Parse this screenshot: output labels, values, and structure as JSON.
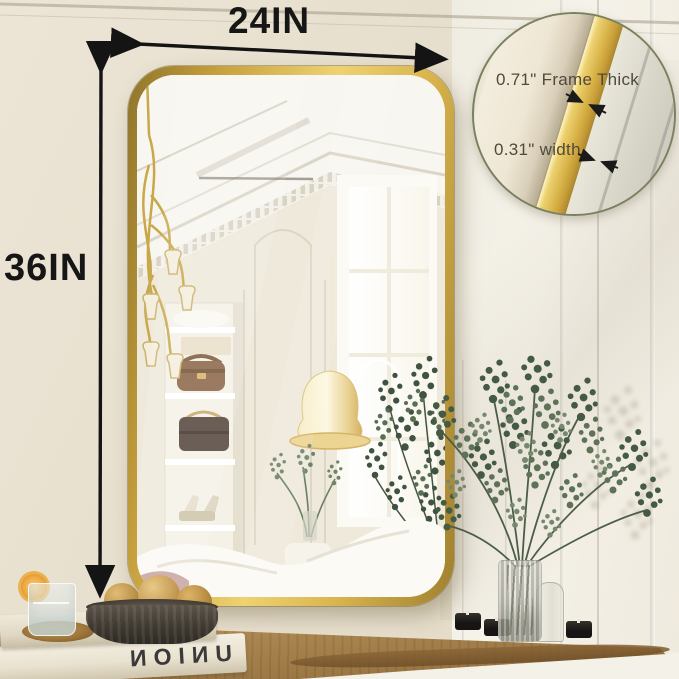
{
  "annotations": {
    "width_label": "24IN",
    "height_label": "36IN"
  },
  "inset": {
    "thickness_label": "0.71\" Frame Thick",
    "width_label": "0.31\" width"
  },
  "books": [
    {
      "title": "CEREAL"
    },
    {
      "title": "UNION"
    }
  ],
  "colors": {
    "frame_gold": "#d9b44a",
    "wall_left": "#e8e1d1",
    "wall_right": "#f3f0e7",
    "table_wood": "#a9854f",
    "annotation_text": "#161616",
    "inset_text": "#51493a",
    "inset_ring": "#79815f",
    "plant_green": "#55684f",
    "book_spine_text": "#3a3a3a"
  }
}
